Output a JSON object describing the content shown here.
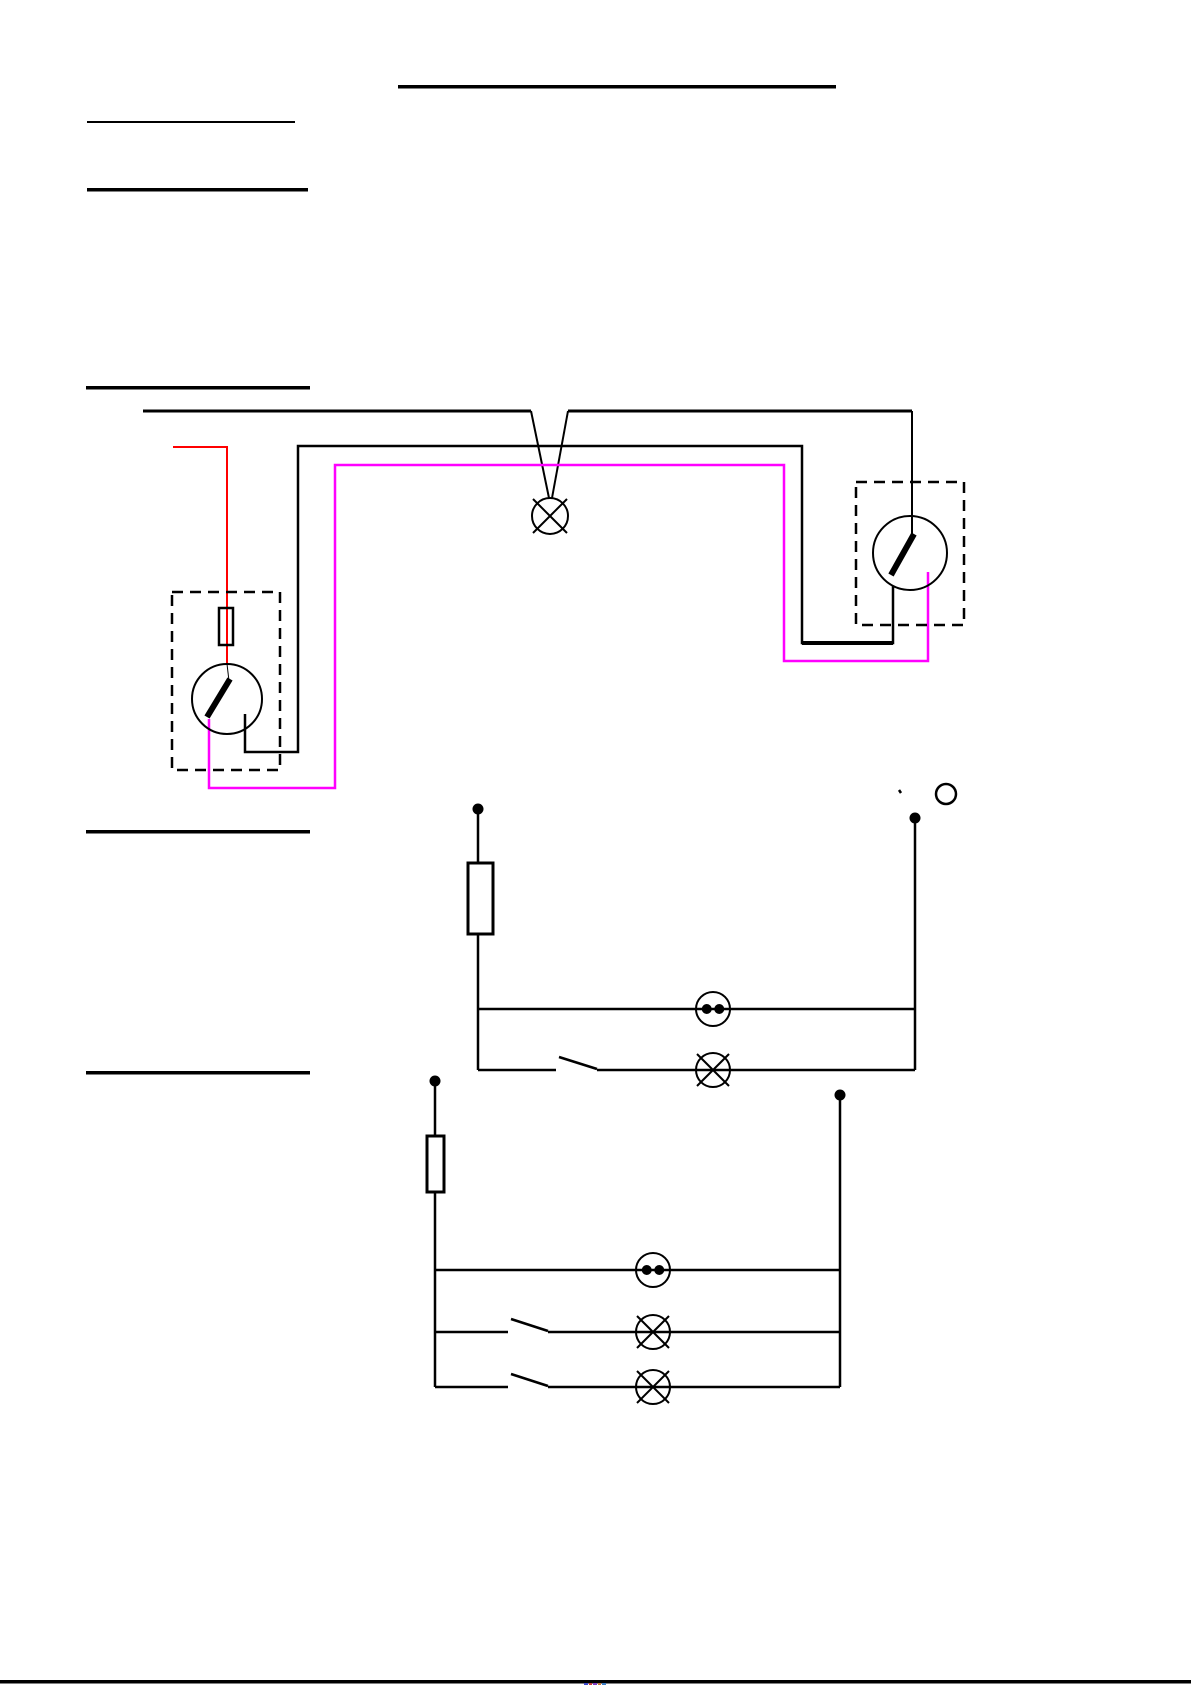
{
  "page": {
    "width": 1191,
    "height": 1685,
    "background": "#ffffff"
  },
  "colors": {
    "black": "#000000",
    "red": "#ff0000",
    "magenta": "#ff00ff",
    "white": "#ffffff"
  },
  "headings": {
    "note": "headings are blank underlined rules (no visible text)",
    "underlines": [
      {
        "name": "title-underline",
        "x": 398,
        "y": 85,
        "w": 438,
        "h": 3.5
      },
      {
        "name": "heading1-underline",
        "x": 87,
        "y": 121,
        "w": 208,
        "h": 2
      },
      {
        "name": "heading2-underline",
        "x": 87,
        "y": 188,
        "w": 221,
        "h": 3.5
      },
      {
        "name": "heading3-underline",
        "x": 86,
        "y": 386,
        "w": 224,
        "h": 3.5
      },
      {
        "name": "heading4-underline",
        "x": 86,
        "y": 830,
        "w": 224,
        "h": 3.5
      },
      {
        "name": "heading5-underline",
        "x": 86,
        "y": 1071,
        "w": 224,
        "h": 3.5
      }
    ]
  },
  "footer": {
    "rule": {
      "name": "bottom-page-rule",
      "x": 0,
      "y": 1680,
      "w": 1191,
      "h": 3.5
    },
    "specks": [
      {
        "name": "clipped-color-speck",
        "x": 584,
        "y": 1683,
        "w": 4,
        "h": 2,
        "c": "#3b48c8"
      },
      {
        "name": "clipped-color-speck",
        "x": 589,
        "y": 1683,
        "w": 3,
        "h": 2,
        "c": "#c23b3b"
      },
      {
        "name": "clipped-color-speck",
        "x": 593,
        "y": 1683,
        "w": 4,
        "h": 2,
        "c": "#7c3bc2"
      },
      {
        "name": "clipped-color-speck",
        "x": 598,
        "y": 1683,
        "w": 3,
        "h": 2,
        "c": "#c2763b"
      },
      {
        "name": "clipped-color-speck",
        "x": 602,
        "y": 1683,
        "w": 4,
        "h": 2,
        "c": "#3b7cc2"
      }
    ]
  },
  "diagrams": [
    {
      "id": "two-way-switch-wiring-diagram",
      "shapes": [
        {
          "t": "line",
          "name": "mains-top-wire-left",
          "x1": 143,
          "y1": 411,
          "x2": 531,
          "y2": 411,
          "w": 3
        },
        {
          "t": "line",
          "name": "mains-top-wire-right",
          "x1": 568,
          "y1": 411,
          "x2": 912,
          "y2": 411,
          "w": 3
        },
        {
          "t": "line",
          "name": "lamp-drop-wire-left",
          "x1": 531,
          "y1": 411,
          "x2": 549,
          "y2": 498,
          "w": 2
        },
        {
          "t": "line",
          "name": "lamp-drop-wire-right",
          "x1": 568,
          "y1": 411,
          "x2": 552,
          "y2": 498,
          "w": 2
        },
        {
          "t": "line",
          "name": "switch2-feed-wire",
          "x1": 912,
          "y1": 411,
          "x2": 912,
          "y2": 536,
          "w": 2
        },
        {
          "t": "lamp",
          "name": "ceiling-lamp-symbol",
          "cx": 550,
          "cy": 516,
          "r": 18,
          "w": 2
        },
        {
          "t": "pline",
          "name": "switched-live-black-wire",
          "pts": [
            [
              245,
              714
            ],
            [
              245,
              752
            ],
            [
              298,
              752
            ],
            [
              298,
              446
            ],
            [
              802,
              446
            ],
            [
              802,
              643
            ],
            [
              893,
              643
            ],
            [
              893,
              586
            ]
          ],
          "w": 2.5
        },
        {
          "t": "line",
          "name": "switched-live-thick-segment",
          "x1": 802,
          "y1": 643,
          "x2": 893,
          "y2": 643,
          "w": 4
        },
        {
          "t": "pline",
          "name": "neutral-magenta-wire",
          "c": "magenta",
          "pts": [
            [
              209,
              719
            ],
            [
              209,
              788
            ],
            [
              335,
              788
            ],
            [
              335,
              465
            ],
            [
              784,
              465
            ],
            [
              784,
              661
            ],
            [
              928,
              661
            ],
            [
              928,
              572
            ]
          ],
          "w": 2.5
        },
        {
          "t": "pline",
          "name": "live-red-wire",
          "c": "red",
          "pts": [
            [
              173,
              447
            ],
            [
              227,
              447
            ],
            [
              227,
              664
            ]
          ],
          "w": 2
        },
        {
          "t": "line",
          "name": "switch1-entry-line",
          "x1": 227,
          "y1": 664,
          "x2": 229,
          "y2": 681,
          "w": 1
        },
        {
          "t": "rect",
          "name": "fuse-symbol",
          "x": 219,
          "y": 608,
          "wd": 14,
          "ht": 37,
          "w": 2.5
        },
        {
          "t": "rect",
          "name": "switch1-enclosure-box",
          "x": 172,
          "y": 592,
          "wd": 108,
          "ht": 178,
          "w": 2.5,
          "dash": true
        },
        {
          "t": "circle",
          "name": "switch1-body",
          "cx": 227,
          "cy": 699,
          "r": 35,
          "w": 2
        },
        {
          "t": "line",
          "name": "switch1-lever",
          "x1": 207,
          "y1": 717,
          "x2": 230,
          "y2": 679,
          "w": 6
        },
        {
          "t": "rect",
          "name": "switch2-enclosure-box",
          "x": 856,
          "y": 482,
          "wd": 108,
          "ht": 143,
          "w": 2.5,
          "dash": true
        },
        {
          "t": "circle",
          "name": "switch2-body",
          "cx": 910,
          "cy": 553,
          "r": 37,
          "w": 2
        },
        {
          "t": "line",
          "name": "switch2-lever",
          "x1": 891,
          "y1": 575,
          "x2": 914,
          "y2": 534,
          "w": 6
        }
      ]
    },
    {
      "id": "circuit-schematic-one-lamp",
      "shapes": [
        {
          "t": "dot",
          "name": "supply-terminal-left",
          "cx": 478,
          "cy": 809,
          "r": 5.5
        },
        {
          "t": "line",
          "name": "left-conductor",
          "x1": 478,
          "y1": 813,
          "x2": 478,
          "y2": 1070,
          "w": 2.5
        },
        {
          "t": "rect",
          "name": "fuse-symbol",
          "x": 468,
          "y": 863,
          "wd": 25,
          "ht": 71,
          "w": 3,
          "fill": "#ffffff"
        },
        {
          "t": "dot",
          "name": "supply-terminal-right",
          "cx": 915,
          "cy": 818,
          "r": 5.5
        },
        {
          "t": "line",
          "name": "right-conductor",
          "x1": 915,
          "y1": 822,
          "x2": 915,
          "y2": 1070,
          "w": 2.5
        },
        {
          "t": "line",
          "name": "socket-branch-wire",
          "x1": 478,
          "y1": 1009,
          "x2": 915,
          "y2": 1009,
          "w": 2.5
        },
        {
          "t": "twodot",
          "name": "socket-outlet-symbol",
          "cx": 713,
          "cy": 1009,
          "r": 17,
          "w": 2
        },
        {
          "t": "line",
          "name": "lamp-branch-wire-left",
          "x1": 478,
          "y1": 1070,
          "x2": 556,
          "y2": 1070,
          "w": 2.5
        },
        {
          "t": "line",
          "name": "switch-blade",
          "x1": 559,
          "y1": 1057,
          "x2": 597,
          "y2": 1069,
          "w": 2.5
        },
        {
          "t": "line",
          "name": "lamp-branch-wire-right",
          "x1": 597,
          "y1": 1070,
          "x2": 915,
          "y2": 1070,
          "w": 2.5
        },
        {
          "t": "lamp",
          "name": "lamp-symbol",
          "cx": 713,
          "cy": 1070,
          "r": 17,
          "w": 2
        },
        {
          "t": "line",
          "name": "stray-mark",
          "x1": 899,
          "y1": 790,
          "x2": 901,
          "y2": 793,
          "w": 2.5
        },
        {
          "t": "circle",
          "name": "annotation-circle",
          "cx": 946,
          "cy": 794,
          "r": 10,
          "w": 2.5
        }
      ]
    },
    {
      "id": "circuit-schematic-two-lamps",
      "shapes": [
        {
          "t": "dot",
          "name": "supply-terminal-left",
          "cx": 435,
          "cy": 1081,
          "r": 5.5
        },
        {
          "t": "line",
          "name": "left-conductor",
          "x1": 435,
          "y1": 1085,
          "x2": 435,
          "y2": 1387,
          "w": 2.5
        },
        {
          "t": "rect",
          "name": "fuse-symbol",
          "x": 427,
          "y": 1136,
          "wd": 17,
          "ht": 56,
          "w": 3,
          "fill": "#ffffff"
        },
        {
          "t": "dot",
          "name": "supply-terminal-right",
          "cx": 840,
          "cy": 1095,
          "r": 5.5
        },
        {
          "t": "line",
          "name": "right-conductor",
          "x1": 840,
          "y1": 1099,
          "x2": 840,
          "y2": 1387,
          "w": 2.5
        },
        {
          "t": "line",
          "name": "socket-branch-wire",
          "x1": 435,
          "y1": 1270,
          "x2": 840,
          "y2": 1270,
          "w": 2.5
        },
        {
          "t": "twodot",
          "name": "socket-outlet-symbol",
          "cx": 653,
          "cy": 1270,
          "r": 17,
          "w": 2
        },
        {
          "t": "line",
          "name": "lamp1-branch-wire-left",
          "x1": 435,
          "y1": 1332,
          "x2": 508,
          "y2": 1332,
          "w": 2.5
        },
        {
          "t": "line",
          "name": "switch1-blade",
          "x1": 511,
          "y1": 1319,
          "x2": 548,
          "y2": 1331,
          "w": 2.5
        },
        {
          "t": "line",
          "name": "lamp1-branch-wire-right",
          "x1": 548,
          "y1": 1332,
          "x2": 840,
          "y2": 1332,
          "w": 2.5
        },
        {
          "t": "lamp",
          "name": "lamp1-symbol",
          "cx": 653,
          "cy": 1332,
          "r": 17,
          "w": 2
        },
        {
          "t": "line",
          "name": "lamp2-branch-wire-left",
          "x1": 435,
          "y1": 1387,
          "x2": 508,
          "y2": 1387,
          "w": 2.5
        },
        {
          "t": "line",
          "name": "switch2-blade",
          "x1": 511,
          "y1": 1374,
          "x2": 548,
          "y2": 1386,
          "w": 2.5
        },
        {
          "t": "line",
          "name": "lamp2-branch-wire-right",
          "x1": 548,
          "y1": 1387,
          "x2": 840,
          "y2": 1387,
          "w": 2.5
        },
        {
          "t": "lamp",
          "name": "lamp2-symbol",
          "cx": 653,
          "cy": 1387,
          "r": 17,
          "w": 2
        }
      ]
    }
  ]
}
